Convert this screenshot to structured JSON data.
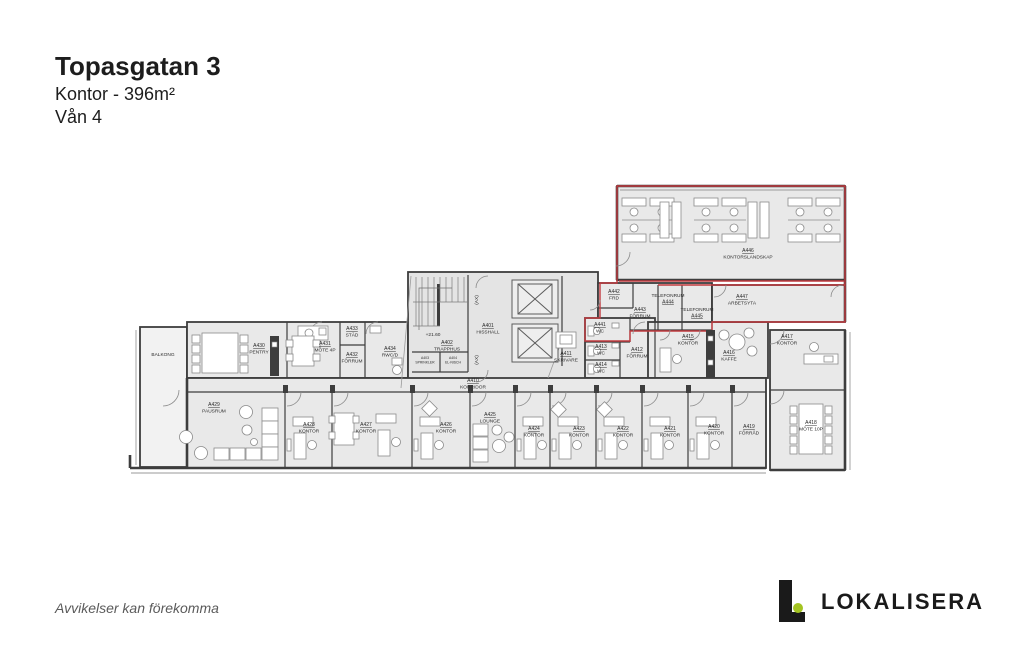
{
  "header": {
    "title": "Topasgatan 3",
    "subtitle": "Kontor - 396m²",
    "floor": "Vån 4"
  },
  "footer": {
    "disclaimer": "Avvikelser kan förekomma",
    "brand": "LOKALISERA"
  },
  "colors": {
    "lease_outline": "#c23a3f",
    "wall": "#3d3d3d",
    "room_fill": "#e9e9e9",
    "brand_green": "#a4c422"
  },
  "plan": {
    "rooms": [
      {
        "id": "A446",
        "name": "KONTORSLANDSKAP"
      },
      {
        "id": "A447",
        "name": "ARBETSYTA"
      },
      {
        "id": "A442",
        "name": "FRD"
      },
      {
        "id": "A443",
        "name": "FÖRRUM"
      },
      {
        "id": "A444",
        "name": "TELEFONRUM"
      },
      {
        "id": "A445",
        "name": "TELEFONRUM"
      },
      {
        "id": "A441",
        "name": "WC"
      },
      {
        "id": "A413",
        "name": "WC"
      },
      {
        "id": "A414",
        "name": "WC"
      },
      {
        "id": "A412",
        "name": "FÖRRUM"
      },
      {
        "id": "A411",
        "name": "SKRIVARE"
      },
      {
        "id": "A401",
        "name": "HISSHALL"
      },
      {
        "id": "A402",
        "name": "TRAPPHUS"
      },
      {
        "id": "A403",
        "name": "SPRINKLER"
      },
      {
        "id": "A404",
        "name": "EL-NISCH"
      },
      {
        "id": "A410",
        "name": "KORRIDOR"
      },
      {
        "id": "A415",
        "name": "KONTOR"
      },
      {
        "id": "A416",
        "name": "KAFFE"
      },
      {
        "id": "A417",
        "name": "KONTOR"
      },
      {
        "id": "A418",
        "name": "MÖTE 10P"
      },
      {
        "id": "A419",
        "name": "FÖRRÅD"
      },
      {
        "id": "A420",
        "name": "KONTOR"
      },
      {
        "id": "A421",
        "name": "KONTOR"
      },
      {
        "id": "A422",
        "name": "KONTOR"
      },
      {
        "id": "A423",
        "name": "KONTOR"
      },
      {
        "id": "A424",
        "name": "KONTOR"
      },
      {
        "id": "A425",
        "name": "LOUNGE"
      },
      {
        "id": "A426",
        "name": "KONTOR"
      },
      {
        "id": "A427",
        "name": "KONTOR"
      },
      {
        "id": "A428",
        "name": "KONTOR"
      },
      {
        "id": "A429",
        "name": "PAUSRUM"
      },
      {
        "id": "A430",
        "name": "PENTRY"
      },
      {
        "id": "A431",
        "name": "MÖTE 4P"
      },
      {
        "id": "A432",
        "name": "FÖRRUM"
      },
      {
        "id": "A433",
        "name": "STÄD"
      },
      {
        "id": "A434",
        "name": "RWC/D"
      }
    ],
    "annotations": {
      "balcony": "BALKONG",
      "level": "+21.60",
      "shaft": "(AX)"
    }
  }
}
